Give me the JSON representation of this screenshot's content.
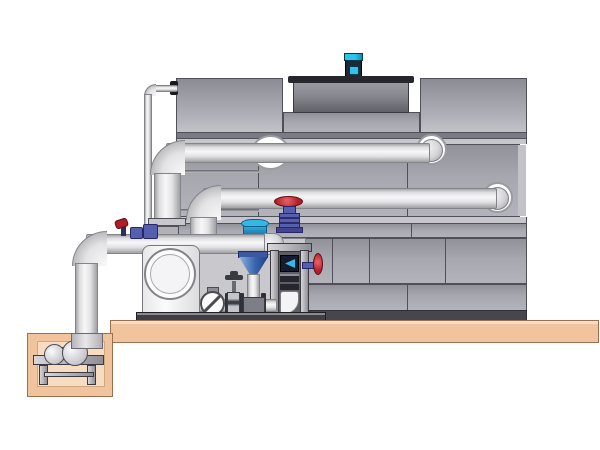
{
  "description": "Technical side-view illustration of a closed cooling tower with two large horizontal inlet/outlet pipes, a circulation pump skid with separator and valves, a small-bore line, a fan cowl with motor on top, and a sump pit with pump set into a tan concrete pad.",
  "palette": {
    "background": "#ffffff",
    "tower_panel": "#a2a2aa",
    "tower_seam": "#50505a",
    "tower_base_rail": "#46464e",
    "fan_cowl_rim": "#26262c",
    "pipe_edge": "#83838a",
    "slab_tan": "#f2c49e",
    "slab_edge": "#9a7150",
    "pit_inner": "#f8dcc2",
    "motor_cyan": "#2ec3e8",
    "motor_dark": "#1d2a33",
    "valve_red": "#b01e26",
    "valve_purple": "#565fae",
    "separator_blue": "#35b8e6",
    "funnel_blue": "#3a66ae",
    "metal_dark": "#3a3a42"
  },
  "components": {
    "tower": "cooling-tower-casing",
    "fan_cowl": "fan-cowl",
    "fan_motor": "fan-motor",
    "upper_pipe": "upper-inlet-pipe",
    "lower_pipe": "lower-inlet-pipe",
    "suction_pipe": "pump-suction-header",
    "makeup_line": "small-bore-makeup-line",
    "pump": "circulation-pump",
    "separator": "centrifugal-separator",
    "globe_valve": "globe-valve-red-handwheel",
    "filter_column": "filter-column-frame",
    "side_valve": "side-handwheel-valve",
    "check_valve": "check-valve",
    "gate_valve": "gate-valve",
    "skid": "equipment-skid",
    "slab": "concrete-pad",
    "pit": "sump-pit",
    "sump_pump": "sump-pump"
  }
}
